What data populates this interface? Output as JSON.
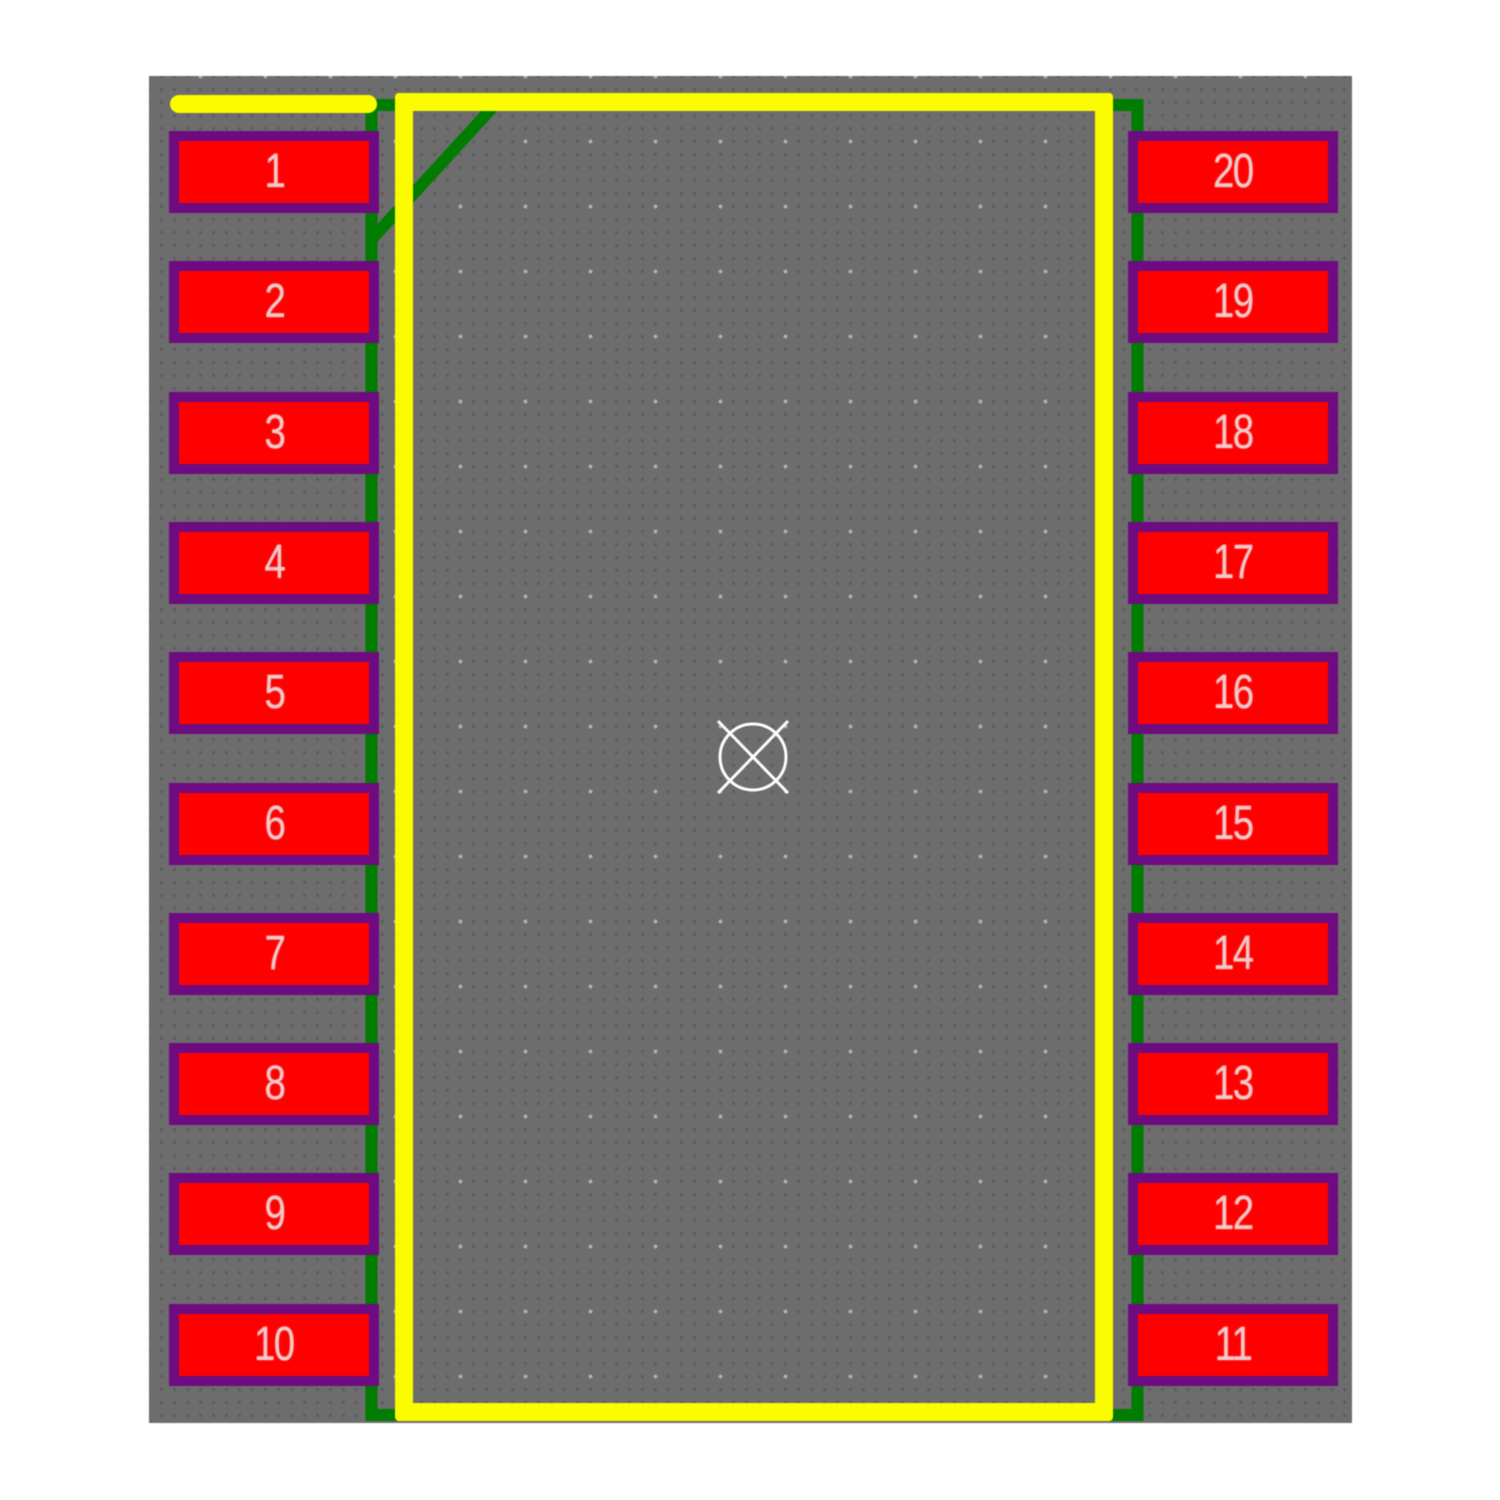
{
  "footprint": {
    "pad_count": 20,
    "left_pads": [
      "1",
      "2",
      "3",
      "4",
      "5",
      "6",
      "7",
      "8",
      "9",
      "10"
    ],
    "right_pads": [
      "20",
      "19",
      "18",
      "17",
      "16",
      "15",
      "14",
      "13",
      "12",
      "11"
    ]
  },
  "colors": {
    "canvas_bg": "#6d6d6d",
    "pad_fill": "#ff0000",
    "pad_border": "#6e0b80",
    "pad_text": "#f2c9c9",
    "silkscreen": "#fcfc00",
    "fab_line": "#007c00",
    "origin_marker": "#fdfdfd"
  }
}
